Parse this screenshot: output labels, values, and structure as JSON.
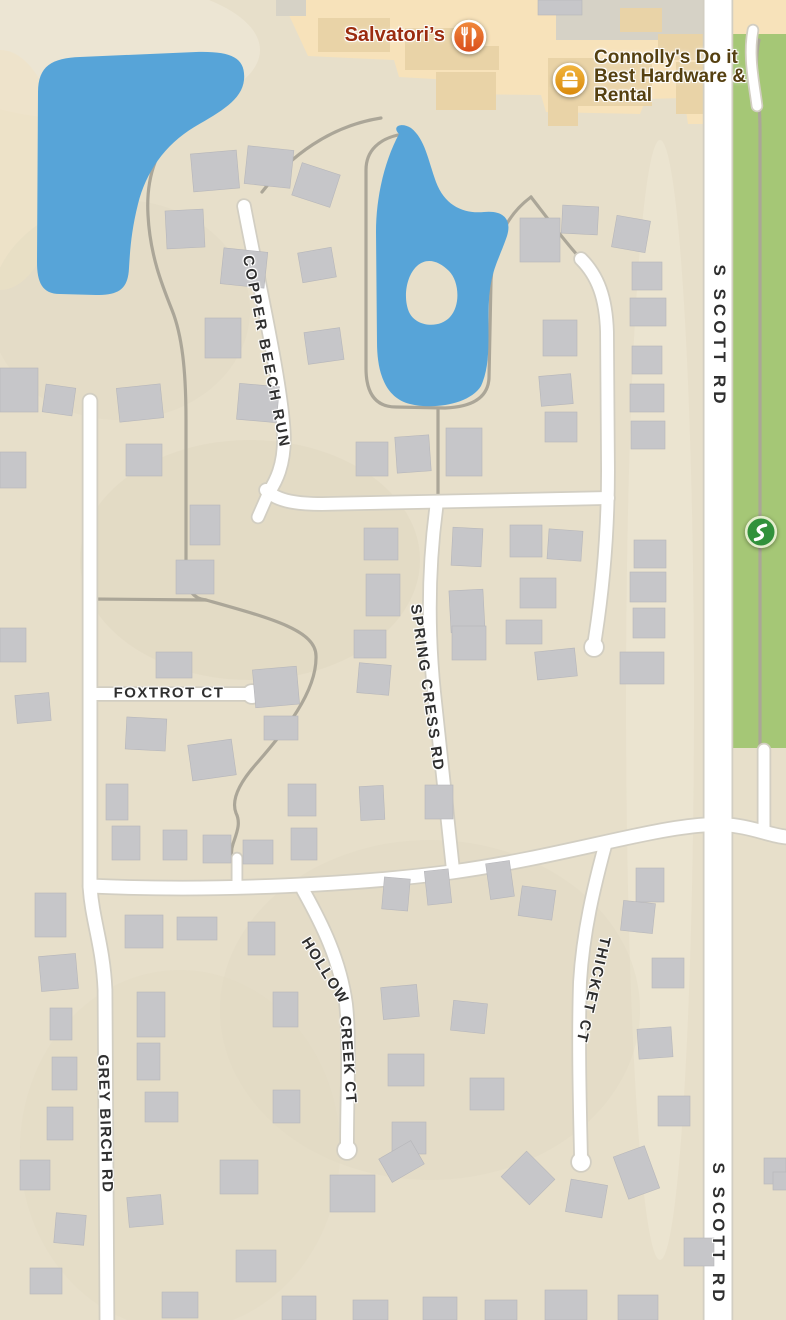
{
  "map": {
    "streets": {
      "copper_beech": "COPPER BEECH RUN",
      "spring_cress": "SPRING CRESS RD",
      "foxtrot": "FOXTROT CT",
      "grey_birch": "GREY BIRCH RD",
      "hollow_creek": "HOLLOW CREEK CT",
      "hollow_creek_parts": [
        "HOLLOW",
        "CREEK CT"
      ],
      "thicket": "THICKET CT",
      "s_scott_top": "S SCOTT RD",
      "s_scott_bottom": "S SCOTT RD"
    },
    "poi": {
      "restaurant": {
        "name": "Salvatori’s",
        "icon": "fork-knife",
        "label_color": "#9b2c0f",
        "icon_color": "#e2571f"
      },
      "hardware": {
        "line1": "Connolly's Do it",
        "line2": "Best Hardware &",
        "line3": "Rental",
        "icon": "tool-bag",
        "label_color": "#554010",
        "icon_color": "#e09a1c"
      },
      "trail_marker": {
        "icon": "winding-trail",
        "icon_color": "#31913b"
      }
    },
    "colors": {
      "land": "#e7dfca",
      "commercial": "#f7e2ba",
      "commercial_building": "#e9d3a7",
      "parking": "#d6d2c6",
      "green": "#a5c776",
      "water": "#57a4d8",
      "trail": "#aba698",
      "road": "#ffffff",
      "road_casing": "#d2cec2",
      "building": "#c6c6c9",
      "building_edge": "#b6b6ba",
      "label_text": "#2f2f2f"
    },
    "geometry": {
      "green": [
        733,
        34,
        53,
        714
      ],
      "commercial": "M 282,0 L 308,56 L 394,60 L 399,77 L 452,80 L 455,94 L 541,95 L 546,112 L 640,114 L 646,99 L 684,98 L 688,124 L 786,124 L 786,0 Z",
      "parking": [
        [
          556,
          0,
          158,
          40
        ],
        [
          276,
          0,
          30,
          16
        ]
      ],
      "commercial_buildings": [
        [
          318,
          18,
          72,
          34
        ],
        [
          405,
          28,
          58,
          42
        ],
        [
          436,
          72,
          60,
          38
        ],
        [
          463,
          46,
          36,
          24
        ],
        [
          548,
          58,
          104,
          48
        ],
        [
          548,
          106,
          30,
          20
        ],
        [
          620,
          8,
          42,
          24
        ],
        [
          658,
          34,
          48,
          26
        ],
        [
          676,
          62,
          44,
          52
        ]
      ],
      "shades": [
        [
          660,
          700,
          34,
          560,
          "#eee8d6",
          0.55
        ],
        [
          90,
          50,
          170,
          70,
          "#f0ead9",
          0.6
        ],
        [
          0,
          170,
          60,
          120,
          "#f0e3c8",
          0.7
        ],
        [
          250,
          560,
          170,
          120,
          "#dcd4bd",
          0.35
        ],
        [
          430,
          1010,
          210,
          170,
          "#ded6c0",
          0.3
        ],
        [
          120,
          310,
          130,
          110,
          "#ded6c0",
          0.3
        ],
        [
          180,
          1150,
          160,
          180,
          "#ded6c0",
          0.25
        ]
      ],
      "water": [
        "M 38,92 C 38,66 52,58 80,57 L 196,52 C 232,51 246,58 244,80 C 242,100 220,112 196,126 C 165,144 146,172 138,204 C 131,232 130,252 129,268 C 128,290 118,295 96,295 L 60,294 C 42,294 37,282 37,262 Z",
        "M 399,134 C 391,126 402,122 411,128 C 425,139 428,160 436,182 C 445,206 464,214 484,212 C 504,210 512,220 507,236 C 498,262 491,270 489,300 C 487,332 492,362 481,386 C 470,404 434,410 410,404 C 386,398 377,374 377,342 L 376,232 C 376,196 385,160 399,134 Z M 417,266 C 406,276 403,298 409,312 C 416,327 439,329 450,317 C 461,305 459,281 449,271 C 439,261 427,257 417,266 Z"
      ],
      "trails": [
        "M 759,40 C 753,66 760,90 760,130 L 760,746",
        "M 190,120 C 155,140 146,180 148,215 C 150,255 162,285 172,310 C 182,335 186,370 186,420 L 186,572 C 186,590 194,599 206,600",
        "M 91,599 L 206,600",
        "M 206,600 C 270,618 316,630 316,656 C 317,692 284,732 257,763 C 239,783 231,800 236,813 C 241,823 237,832 233,844 C 228,858 237,868 235,880",
        "M 531,197 C 508,214 494,240 491,280 L 489,378 C 488,399 470,407 445,408 L 396,407 C 376,407 366,394 366,368 L 366,170 C 366,150 380,139 398,135",
        "M 531,197 C 545,215 562,238 579,257",
        "M 438,410 L 438,495",
        "M 381,118 C 330,126 290,156 262,192"
      ],
      "roads": [
        [
          "M 90,401 L 90,886 C 92,920 103,945 105,990 L 107,1330",
          13
        ],
        [
          "M 90,694 L 246,694",
          12
        ],
        [
          "M 244,206 C 258,280 283,390 284,438 C 284,466 276,481 269,492",
          12
        ],
        [
          "M 269,492 L 258,517",
          11
        ],
        [
          "M 266,490 C 278,502 300,504 322,504 L 608,498",
          12
        ],
        [
          "M 581,259 C 598,276 606,298 607,332 L 608,470 C 608,540 601,602 594,645",
          12
        ],
        [
          "M 437,502 C 429,560 427,622 434,692 C 441,762 448,822 453,870",
          12
        ],
        [
          "M 303,890 C 322,924 340,960 346,1004 C 350,1040 347,1090 347,1146",
          12
        ],
        [
          "M 606,842 C 594,886 583,932 580,982 C 578,1042 580,1112 581,1158",
          12
        ],
        [
          "M 90,886 C 220,892 360,884 452,872 C 560,857 645,829 704,825 C 745,822 765,835 786,837",
          13
        ],
        [
          "M 718,-8 L 718,1330",
          27
        ],
        [
          "M 764,750 L 764,831",
          11
        ],
        [
          "M 753,30 C 748,56 754,82 757,106",
          9
        ],
        [
          "M 237,858 L 237,882",
          9
        ]
      ],
      "bulbs": [
        [
          252,
          694,
          9
        ],
        [
          594,
          647,
          9
        ],
        [
          347,
          1150,
          9
        ],
        [
          581,
          1162,
          9
        ]
      ],
      "buildings": [
        [
          0,
          368,
          38,
          44,
          0
        ],
        [
          44,
          386,
          30,
          28,
          8
        ],
        [
          118,
          386,
          44,
          34,
          -6
        ],
        [
          126,
          444,
          36,
          32,
          0
        ],
        [
          0,
          452,
          26,
          36,
          0
        ],
        [
          190,
          505,
          30,
          40,
          0
        ],
        [
          176,
          560,
          38,
          34,
          0
        ],
        [
          0,
          628,
          26,
          34,
          0
        ],
        [
          16,
          694,
          34,
          28,
          -5
        ],
        [
          192,
          152,
          46,
          38,
          -5
        ],
        [
          246,
          148,
          46,
          38,
          6
        ],
        [
          296,
          168,
          40,
          34,
          18
        ],
        [
          166,
          210,
          38,
          38,
          -3
        ],
        [
          222,
          250,
          44,
          36,
          6
        ],
        [
          205,
          318,
          36,
          40,
          0
        ],
        [
          238,
          385,
          40,
          36,
          5
        ],
        [
          300,
          250,
          34,
          30,
          -10
        ],
        [
          306,
          330,
          36,
          32,
          -8
        ],
        [
          538,
          0,
          44,
          15,
          0
        ],
        [
          520,
          218,
          40,
          44,
          0
        ],
        [
          562,
          206,
          36,
          28,
          3
        ],
        [
          543,
          320,
          34,
          36,
          0
        ],
        [
          540,
          375,
          32,
          30,
          -5
        ],
        [
          545,
          412,
          32,
          30,
          0
        ],
        [
          510,
          525,
          32,
          32,
          0
        ],
        [
          548,
          530,
          34,
          30,
          4
        ],
        [
          520,
          578,
          36,
          30,
          0
        ],
        [
          506,
          620,
          36,
          24,
          0
        ],
        [
          536,
          650,
          40,
          28,
          -6
        ],
        [
          614,
          218,
          34,
          32,
          10
        ],
        [
          632,
          262,
          30,
          28,
          0
        ],
        [
          630,
          298,
          36,
          28,
          0
        ],
        [
          632,
          346,
          30,
          28,
          0
        ],
        [
          630,
          384,
          34,
          28,
          0
        ],
        [
          631,
          421,
          34,
          28,
          0
        ],
        [
          634,
          540,
          32,
          28,
          0
        ],
        [
          630,
          572,
          36,
          30,
          0
        ],
        [
          633,
          608,
          32,
          30,
          0
        ],
        [
          620,
          652,
          44,
          32,
          0
        ],
        [
          356,
          442,
          32,
          34,
          0
        ],
        [
          396,
          436,
          34,
          36,
          -4
        ],
        [
          446,
          428,
          36,
          48,
          0
        ],
        [
          364,
          528,
          34,
          32,
          0
        ],
        [
          452,
          528,
          30,
          38,
          3
        ],
        [
          366,
          574,
          34,
          42,
          0
        ],
        [
          450,
          590,
          34,
          42,
          -3
        ],
        [
          354,
          630,
          32,
          28,
          0
        ],
        [
          452,
          626,
          34,
          34,
          0
        ],
        [
          358,
          664,
          32,
          30,
          5
        ],
        [
          156,
          652,
          36,
          26,
          0
        ],
        [
          254,
          668,
          44,
          38,
          -5
        ],
        [
          264,
          716,
          34,
          24,
          0
        ],
        [
          126,
          718,
          40,
          32,
          3
        ],
        [
          190,
          742,
          44,
          36,
          -8
        ],
        [
          106,
          784,
          22,
          36,
          0
        ],
        [
          112,
          826,
          28,
          34,
          0
        ],
        [
          163,
          830,
          24,
          30,
          0
        ],
        [
          203,
          835,
          28,
          28,
          0
        ],
        [
          243,
          840,
          30,
          24,
          0
        ],
        [
          288,
          784,
          28,
          32,
          0
        ],
        [
          291,
          828,
          26,
          32,
          0
        ],
        [
          360,
          786,
          24,
          34,
          -3
        ],
        [
          425,
          785,
          28,
          34,
          0
        ],
        [
          383,
          878,
          26,
          32,
          5
        ],
        [
          426,
          870,
          24,
          34,
          -6
        ],
        [
          488,
          862,
          24,
          36,
          -8
        ],
        [
          520,
          888,
          34,
          30,
          8
        ],
        [
          636,
          868,
          28,
          34,
          0
        ],
        [
          35,
          893,
          31,
          44,
          0
        ],
        [
          40,
          955,
          37,
          35,
          -5
        ],
        [
          50,
          1008,
          22,
          32,
          0
        ],
        [
          52,
          1057,
          25,
          33,
          0
        ],
        [
          47,
          1107,
          26,
          33,
          0
        ],
        [
          20,
          1160,
          30,
          30,
          0
        ],
        [
          55,
          1214,
          30,
          30,
          5
        ],
        [
          30,
          1268,
          32,
          26,
          0
        ],
        [
          125,
          915,
          38,
          33,
          0
        ],
        [
          177,
          917,
          40,
          23,
          0
        ],
        [
          248,
          922,
          27,
          33,
          0
        ],
        [
          137,
          992,
          28,
          45,
          0
        ],
        [
          273,
          992,
          25,
          35,
          0
        ],
        [
          137,
          1043,
          23,
          37,
          0
        ],
        [
          145,
          1092,
          33,
          30,
          0
        ],
        [
          273,
          1090,
          27,
          33,
          0
        ],
        [
          128,
          1196,
          34,
          30,
          -5
        ],
        [
          236,
          1250,
          40,
          32,
          0
        ],
        [
          162,
          1292,
          36,
          26,
          0
        ],
        [
          282,
          1296,
          34,
          24,
          0
        ],
        [
          220,
          1160,
          38,
          34,
          0
        ],
        [
          382,
          986,
          36,
          32,
          -5
        ],
        [
          388,
          1054,
          36,
          32,
          0
        ],
        [
          392,
          1122,
          34,
          32,
          0
        ],
        [
          452,
          1002,
          34,
          30,
          6
        ],
        [
          470,
          1078,
          34,
          32,
          0
        ],
        [
          383,
          1148,
          37,
          27,
          -30
        ],
        [
          330,
          1175,
          45,
          37,
          0
        ],
        [
          508,
          1160,
          40,
          36,
          45
        ],
        [
          568,
          1182,
          37,
          33,
          10
        ],
        [
          620,
          1150,
          33,
          45,
          -20
        ],
        [
          353,
          1300,
          35,
          20,
          0
        ],
        [
          423,
          1297,
          34,
          23,
          0
        ],
        [
          485,
          1300,
          32,
          20,
          0
        ],
        [
          545,
          1290,
          42,
          30,
          0
        ],
        [
          618,
          1295,
          40,
          25,
          0
        ],
        [
          622,
          902,
          32,
          30,
          6
        ],
        [
          652,
          958,
          32,
          30,
          0
        ],
        [
          638,
          1028,
          34,
          30,
          -4
        ],
        [
          658,
          1096,
          32,
          30,
          0
        ],
        [
          684,
          1238,
          30,
          28,
          0
        ],
        [
          764,
          1158,
          22,
          26,
          0
        ],
        [
          773,
          1172,
          15,
          18,
          0
        ]
      ]
    }
  }
}
